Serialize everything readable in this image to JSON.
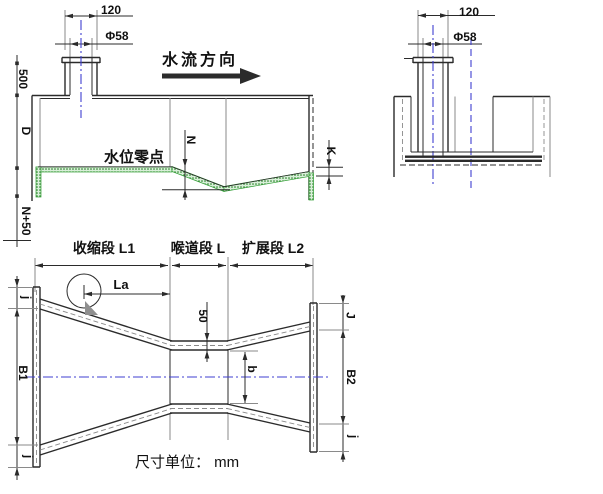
{
  "colors": {
    "bg": "#ffffff",
    "line": "#2b2b2b",
    "gray": "#8a8a8a",
    "green": "#2f9e33",
    "green_dot": "#1c7a1c",
    "green_light": "#d9efd9",
    "blue": "#3f3fd0",
    "triangle": "#8f8f8f",
    "text": "#111111"
  },
  "side_view": {
    "dim_width": "120",
    "dim_pipe": "Φ58",
    "flow_direction": "水流方向",
    "dim_height_500": "500",
    "dim_D": "D",
    "water_zero": "水位零点",
    "dim_N": "N",
    "dim_K": "K",
    "dim_N50": "N+50"
  },
  "end_view": {
    "dim_width": "120",
    "dim_pipe": "Φ58"
  },
  "plan_view": {
    "section_converging": "收缩段 L1",
    "section_throat": "喉道段 L",
    "section_diverging": "扩展段 L2",
    "dim_La": "La",
    "dim_50": "50",
    "dim_b": "b",
    "dim_j_top_left": "j",
    "dim_B1": "B1",
    "dim_j_bottom_left": "j",
    "dim_J_top_right": "J",
    "dim_B2": "B2",
    "dim_j_bottom_right": "j"
  },
  "footer": {
    "unit_note": "尺寸单位： mm"
  }
}
